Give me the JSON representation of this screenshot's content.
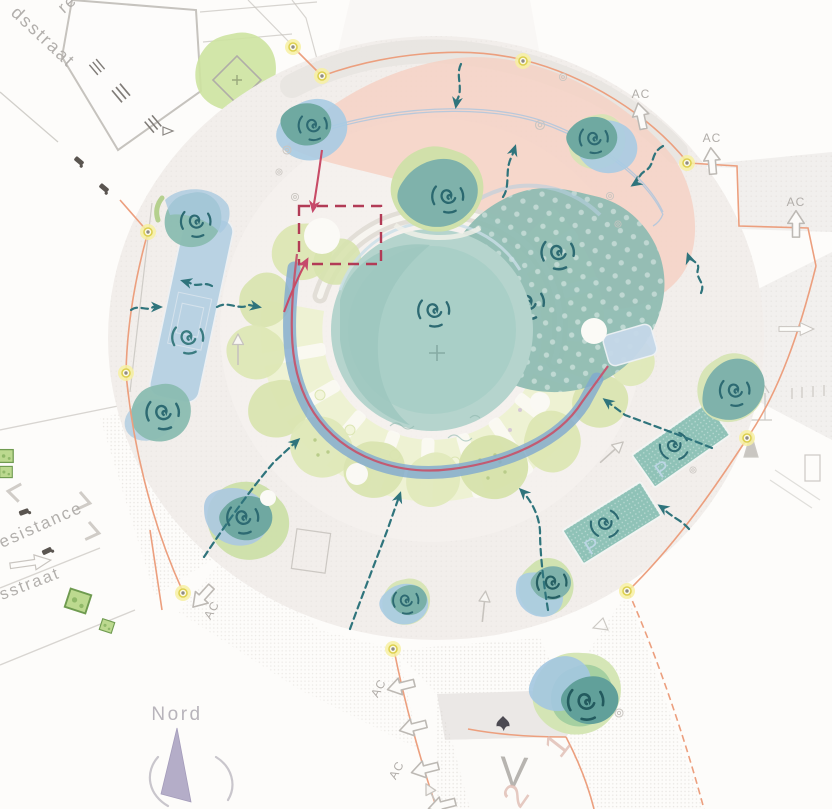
{
  "labels": {
    "street_nw_partial": "re",
    "street_nw": "dsstraat",
    "street_w": "esistance",
    "street_sw": "sstraat",
    "compass": "Nord",
    "ac": "AC",
    "parking": "P",
    "road_v": "V",
    "num1": "1",
    "num2": "2"
  },
  "colors": {
    "background": "#fdfcfa",
    "plaza_fill": "#f2eeeb",
    "pink_zone": "#f6cfc1",
    "pond_teal": "#a9cfc7",
    "canopy_teal": "#8fbcb2",
    "tree_green": "#dce6b3",
    "ray_band_green": "#edf2d0",
    "canal_blue": "#b5d0e3",
    "pond_blue": "#a9cbe3",
    "stream_blue": "#7fa9cf",
    "stream_red": "#c25b72",
    "flow_arrow_teal": "#2f747c",
    "spiral_teal": "#2d6a72",
    "boundary_orange": "#ec9f7e",
    "survey_yellow": "#f7f0a2",
    "annotation_red": "#b23b56",
    "label_gray": "#b4b0ac",
    "compass_needle": "#b4adc8"
  },
  "icons": {
    "tree": "spiral-tree-icon",
    "flow": "dashed-flow-arrow-icon",
    "survey_point": "survey-point-icon",
    "direction": "hollow-arrow-icon",
    "compass": "north-needle-icon"
  }
}
